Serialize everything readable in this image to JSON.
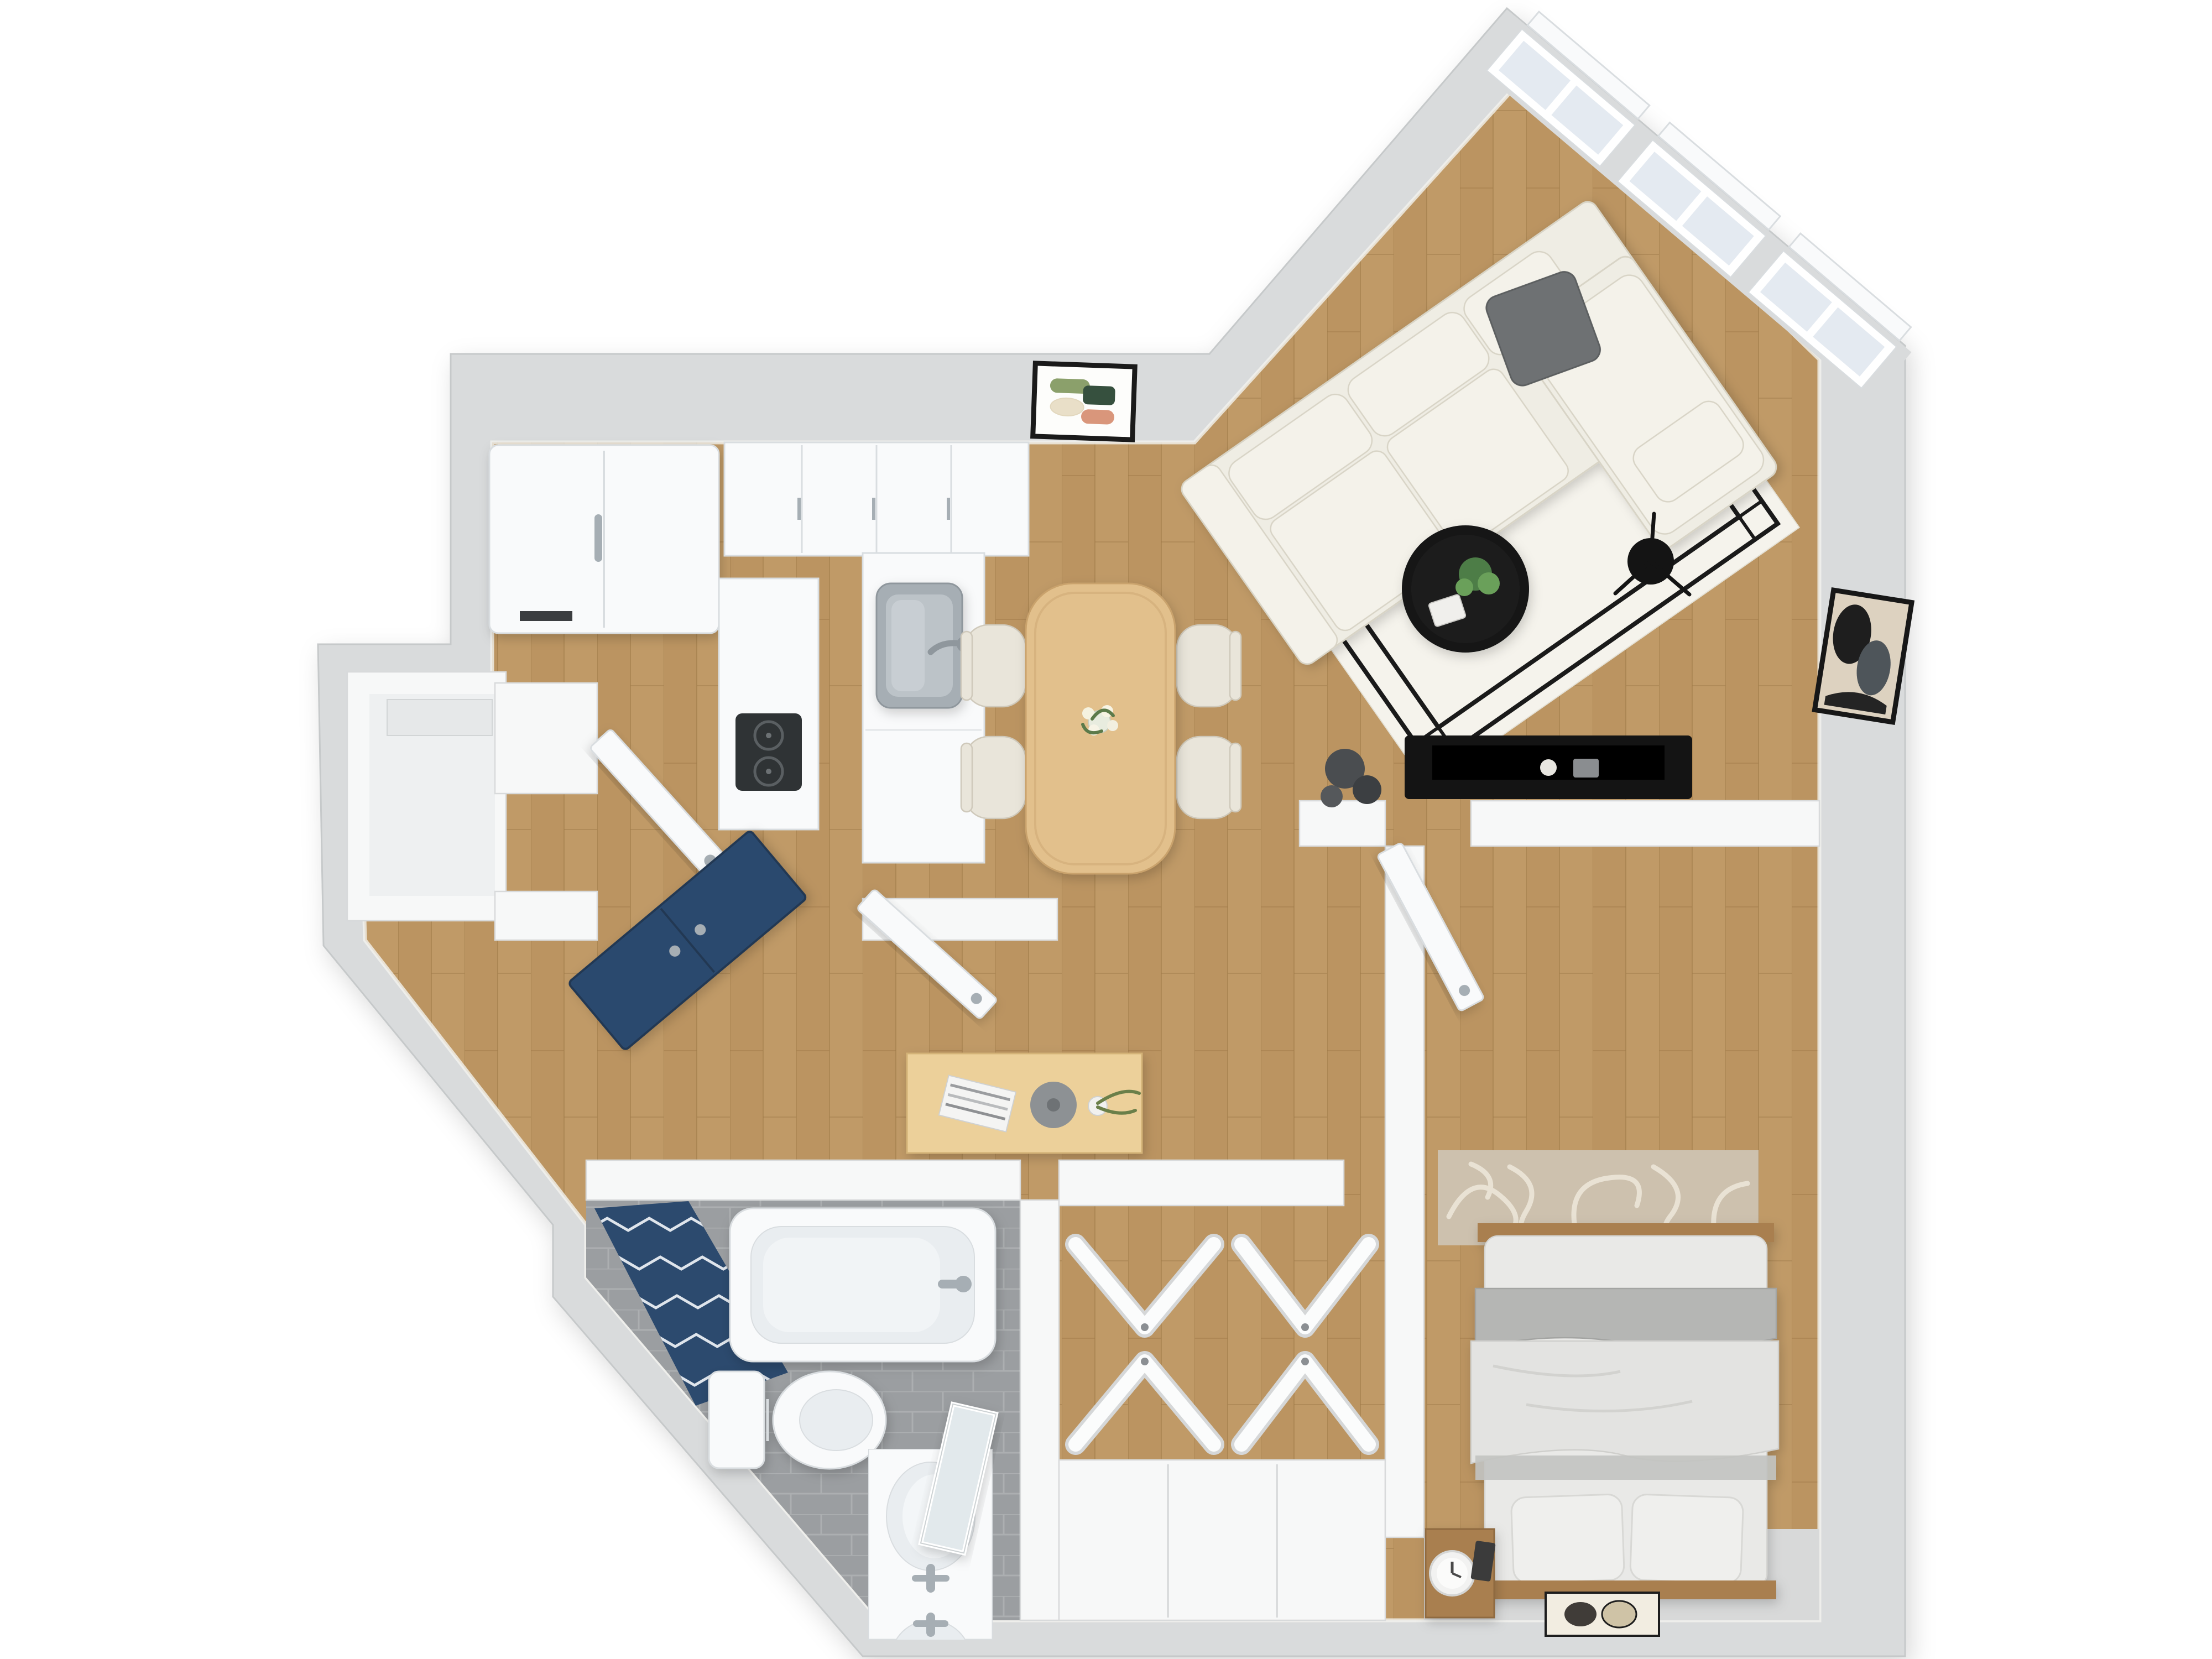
{
  "meta": {
    "type": "3d-floor-plan-render",
    "description": "Top-down 3D rendered floor plan of a one-bedroom apartment, no visible text labels",
    "background": "#ffffff"
  },
  "colors": {
    "wallBand": "#d9dbdc",
    "wallEdge": "#c6c9ca",
    "innerWall": "#f7f8f8",
    "innerWallEdge": "#d8dadb",
    "wood1": "#c09a67",
    "wood2": "#b68f5c",
    "woodLine": "#9c7846",
    "tileBase": "#9b9ea1",
    "tileLine": "#b0b3b5",
    "fixtureWhite": "#f9fafb",
    "fixtureEdge": "#d9dde0",
    "fixtureInner": "#e9edf0",
    "chrome": "#a6aeb4",
    "navy": "#2c4a6e",
    "navyZig": "#dfe5ec",
    "sofaCream": "#efede4",
    "sofaCushion": "#f4f2ea",
    "sofaEdge": "#d8d4c6",
    "pillowGray": "#6e7173",
    "rugLiving": "#f5f3ec",
    "rugBorder": "#1a1a1a",
    "blackFurn": "#141414",
    "plantGreen": "#4e7d46",
    "plantGreenLight": "#6aa05a",
    "tableWood": "#e2c08c",
    "tableWoodEdge": "#c9a26c",
    "chairBeige": "#e9e5da",
    "chairEdge": "#cfc9bb",
    "deskWood": "#ecd09a",
    "deskWoodEdge": "#d3b277",
    "windowGlass": "#e4eaf1",
    "grayFloor": "#d8d9d9",
    "mattress": "#e9e9e7",
    "mattressEdge": "#d5d5d2",
    "blanketGray": "#b5b6b4",
    "duvetWhite": "#e3e3e1",
    "pillowWhite": "#efefed",
    "bedWood": "#a97f4f",
    "rugBedroom": "#cdc1ae",
    "rugBedroomPat": "#e9e2d4",
    "artOlive": "#8ba06b",
    "artDarkGreen": "#36503e",
    "artCream": "#e9dfc8",
    "artSalmon": "#d9967b",
    "artMatBeige": "#ddd2c0",
    "nicheFloor": "#eef0f1"
  },
  "rooms": {
    "living": {
      "label": "Living room",
      "floor": "wood",
      "features": [
        "diagonal window wall",
        "3 windows"
      ]
    },
    "dining": {
      "label": "Dining area",
      "floor": "wood",
      "features": [
        "open to kitchen and living room"
      ]
    },
    "kitchen": {
      "label": "Kitchen",
      "floor": "wood",
      "features": [
        "L-shaped counters"
      ]
    },
    "entry": {
      "label": "Entry hall",
      "floor": "wood",
      "features": [
        "storage niche",
        "angled entry wall"
      ]
    },
    "hallway": {
      "label": "Hallway",
      "floor": "wood",
      "features": [
        "console table"
      ]
    },
    "bathroom": {
      "label": "Bathroom",
      "floor": "gray tile",
      "features": [
        "navy chevron accent wall",
        "angled wall"
      ]
    },
    "closet": {
      "label": "Walk-in closet",
      "floor": "wood",
      "features": [
        "4 bifold doors",
        "wardrobe"
      ]
    },
    "bedroom": {
      "label": "Bedroom",
      "floor": "wood",
      "features": [
        "queen bed",
        "patterned rug"
      ]
    }
  },
  "furniture": {
    "living": [
      "sectional-sofa",
      "gray-throw-pillow",
      "area-rug-black-border",
      "round-coffee-table",
      "potted-plant",
      "book",
      "floor-lamp",
      "media-console",
      "tv-flat",
      "decor-spheres",
      "abstract-wall-art"
    ],
    "dining": [
      "dining-table",
      "dining-chair x4",
      "flower-vase-tulips",
      "framed-abstract-art"
    ],
    "kitchen": [
      "refrigerator",
      "upper-cabinets",
      "counter-right",
      "counter-left",
      "stainless-sink",
      "faucet",
      "cooktop"
    ],
    "entry": [
      "navy-console-cabinet",
      "open-door-leaf x2",
      "storage-niche-shelf"
    ],
    "hallway": [
      "console-desk",
      "magazine-stack",
      "decor-bowl",
      "bud-vase-olive-branch"
    ],
    "bathroom": [
      "bathtub",
      "tub-faucet",
      "toilet",
      "vanity-cabinet",
      "oval-sink x2",
      "sink-faucet x2",
      "leaning-mirror",
      "navy-chevron-tile-wall"
    ],
    "closet": [
      "bifold-door x4",
      "wardrobe-unit"
    ],
    "bedroom": [
      "double-bed",
      "pillow x2",
      "gray-blanket",
      "white-duvet",
      "foot-board",
      "patterned-rug",
      "nightstand",
      "alarm-clock",
      "small-picture-frame",
      "door-leaf",
      "floor-mat-two-ovals"
    ]
  },
  "windows": {
    "count": 3,
    "wall": "northeast diagonal",
    "style": "white frame, double sash, exterior sills"
  }
}
